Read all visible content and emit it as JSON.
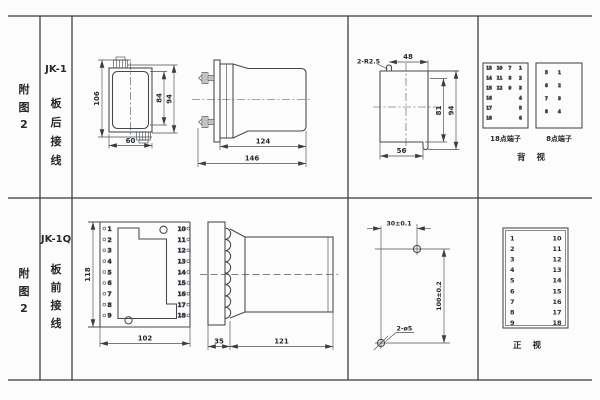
{
  "header": {
    "rows": [
      {
        "fig": [
          "附",
          "图",
          "2"
        ],
        "model": "JK-1",
        "wiring": [
          "板",
          "后",
          "接",
          "线"
        ]
      },
      {
        "fig": [
          "附",
          "图",
          "2"
        ],
        "model": "JK-1Q",
        "wiring": [
          "板",
          "前",
          "接",
          "线"
        ]
      }
    ]
  },
  "jk1": {
    "front_view": {
      "dim_height_total": "106",
      "dim_width": "60",
      "dim_inner_height": "84",
      "dim_outer_height": "94"
    },
    "side_view": {
      "dim_body": "124",
      "dim_total": "146"
    },
    "cutout_view": {
      "corner_note": "2-R2.5",
      "dim_top": "48",
      "dim_inner_height": "81",
      "dim_outer_height": "94",
      "dim_bottom": "56"
    },
    "terminal_panel_18": {
      "label": "18点端子",
      "cells": [
        "13",
        "10",
        "7",
        "1",
        "14",
        "11",
        "8",
        "2",
        "15",
        "12",
        "9",
        "3",
        "16",
        "4",
        "17",
        "5",
        "18",
        "6"
      ]
    },
    "terminal_panel_8": {
      "label": "8点端子",
      "cells": [
        "5",
        "1",
        "6",
        "2",
        "7",
        "3",
        "8",
        "4"
      ]
    },
    "view_label": "背 视"
  },
  "jk1q": {
    "panel_view": {
      "dim_height": "118",
      "dim_width": "102",
      "left_terminals": [
        "1",
        "2",
        "3",
        "4",
        "5",
        "6",
        "7",
        "8",
        "9"
      ],
      "right_terminals": [
        "10",
        "11",
        "12",
        "13",
        "14",
        "15",
        "16",
        "17",
        "18"
      ]
    },
    "side_view": {
      "dim_plate": "35",
      "dim_body": "121"
    },
    "drill_view": {
      "dim_width": "30±0.1",
      "dim_height": "100±0.2",
      "hole_note": "2-ø5"
    },
    "front_panel": {
      "label": "正 视",
      "left": [
        "1",
        "2",
        "3",
        "4",
        "5",
        "6",
        "7",
        "8",
        "9"
      ],
      "right": [
        "10",
        "11",
        "12",
        "13",
        "14",
        "15",
        "16",
        "17",
        "18"
      ]
    }
  }
}
